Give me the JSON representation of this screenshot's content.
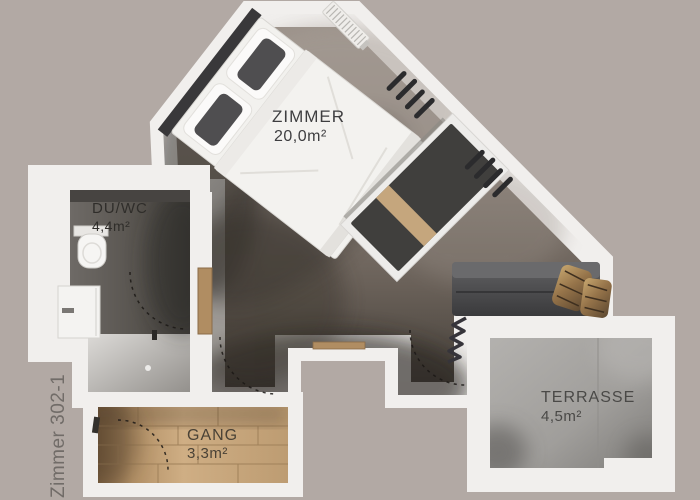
{
  "plan": {
    "unit_label": "Zimmer 302-1",
    "rooms": [
      {
        "id": "zimmer",
        "name": "ZIMMER",
        "area": "20,0m²"
      },
      {
        "id": "duwc",
        "name": "DU/WC",
        "area": "4,4m²"
      },
      {
        "id": "gang",
        "name": "GANG",
        "area": "3,3m²"
      },
      {
        "id": "terrasse",
        "name": "TERRASSE",
        "area": "4,5m²"
      }
    ],
    "colors": {
      "background": "#b2a9a4",
      "wall": "#f1efed",
      "main_floor_dark": "#3f3a34",
      "bathroom_floor": "#58544f",
      "wood_floor": "#cfae84",
      "terrace_floor": "#a09e9b",
      "label_text": "#3f3d3b"
    }
  }
}
